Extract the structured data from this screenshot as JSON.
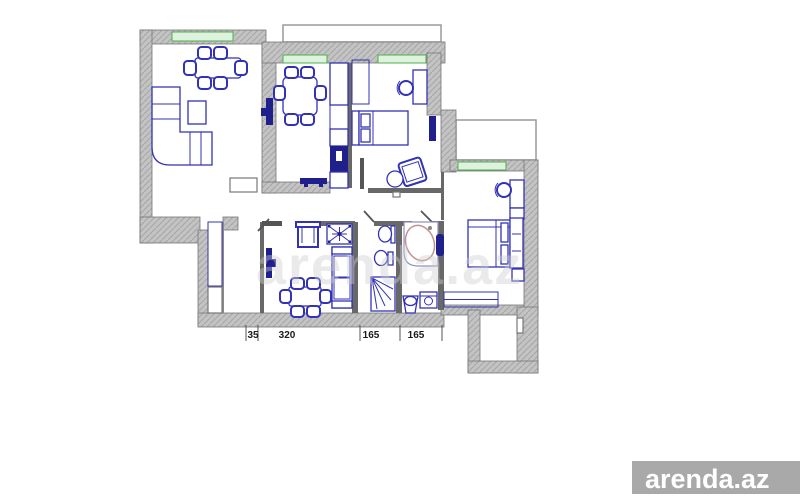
{
  "image": {
    "width": 800,
    "height": 500,
    "background": "#ffffff"
  },
  "watermark": {
    "brand": "arenda.az",
    "faint_text": "arenda.az",
    "badge_bg": "#a9a9a9",
    "badge_text_color": "#ffffff"
  },
  "dimensions": {
    "unit_labels": [
      "35",
      "320",
      "165",
      "165"
    ],
    "label_centers_px": [
      253,
      287,
      371,
      416
    ],
    "tick_positions_px": [
      246,
      258,
      360,
      400,
      442
    ]
  },
  "colors": {
    "wall-fill": "#c3c3c3",
    "wall-hatch": "#a6a6a6",
    "wall-edge": "#757575",
    "partition": "#686868",
    "furniture": "#3232b4",
    "furniture-dark": "#20208c",
    "window-fill": "#def2de",
    "window-stroke": "#4fae4f",
    "tub-stroke": "#c09090",
    "balcony-stroke": "#9a9a9a",
    "dim-text": "#1a1a1a",
    "faint-watermark": "#cfcfcf"
  },
  "floor_plan": {
    "rooms": [
      {
        "name": "living-dining-room",
        "furniture": [
          "dining-table",
          "chair",
          "chair",
          "chair",
          "chair",
          "chair",
          "chair",
          "corner-sofa",
          "coffee-table",
          "dresser",
          "wall-tv"
        ]
      },
      {
        "name": "kitchen",
        "furniture": [
          "dining-table",
          "chair",
          "chair",
          "chair",
          "chair",
          "chair",
          "chair",
          "kitchen-counter",
          "stove",
          "sink",
          "wall-tv"
        ]
      },
      {
        "name": "bedroom-top",
        "furniture": [
          "wardrobe",
          "bed",
          "desk",
          "chair",
          "wall-tv",
          "armchair",
          "side-table"
        ]
      },
      {
        "name": "hallway-closet",
        "furniture": [
          "wardrobe",
          "cabinet"
        ]
      },
      {
        "name": "lounge",
        "furniture": [
          "wall-tv",
          "armchair",
          "decor-table",
          "sofa",
          "dining-table",
          "chair",
          "chair",
          "chair",
          "chair",
          "chair",
          "chair"
        ]
      },
      {
        "name": "wc",
        "furniture": [
          "washbasin",
          "toilet",
          "shower"
        ]
      },
      {
        "name": "bathroom",
        "furniture": [
          "corner-bathtub",
          "water-heater",
          "pedestal-sink",
          "washing-machine"
        ]
      },
      {
        "name": "bedroom-right",
        "furniture": [
          "desk",
          "chair",
          "shelf",
          "double-bed",
          "nightstand",
          "sliding-wardrobe"
        ]
      }
    ],
    "windows": 4,
    "balconies": 2,
    "entrance_vestibule": true
  }
}
